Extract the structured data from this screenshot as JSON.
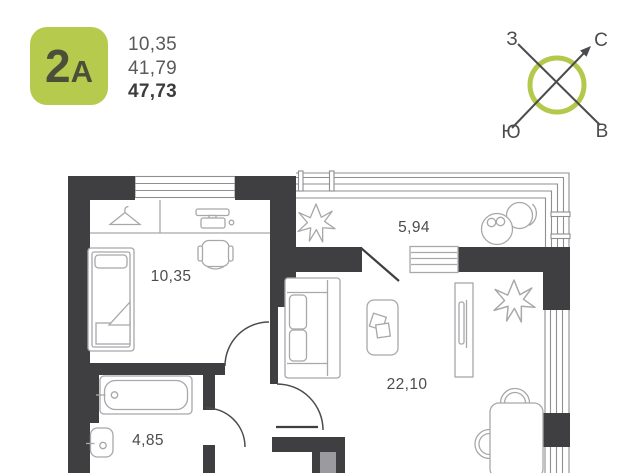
{
  "header": {
    "badge": {
      "digit": "2",
      "letter": "А"
    },
    "areas": [
      {
        "value": "10,35",
        "bold": false
      },
      {
        "value": "41,79",
        "bold": false
      },
      {
        "value": "47,73",
        "bold": true
      }
    ],
    "compass": {
      "west": "З",
      "north": "С",
      "south": "Ю",
      "east": "В"
    }
  },
  "plan": {
    "labels": {
      "bedroom": "10,35",
      "balcony": "5,94",
      "living": "22,10",
      "bathroom": "4,85"
    }
  },
  "colors": {
    "badge_green": "#b6cb4d",
    "badge_text": "#4b4f3a",
    "compass_green": "#b2c94b",
    "wall_dark": "#3f3e41",
    "furniture_gray": "#a8a7aa",
    "label_gray": "#4c4c4e",
    "area_gray": "#5a5a5c",
    "area_dark": "#3c3c3e",
    "door_slab_gray": "#9b9a9e",
    "glazing_gray": "#8f8e91"
  }
}
